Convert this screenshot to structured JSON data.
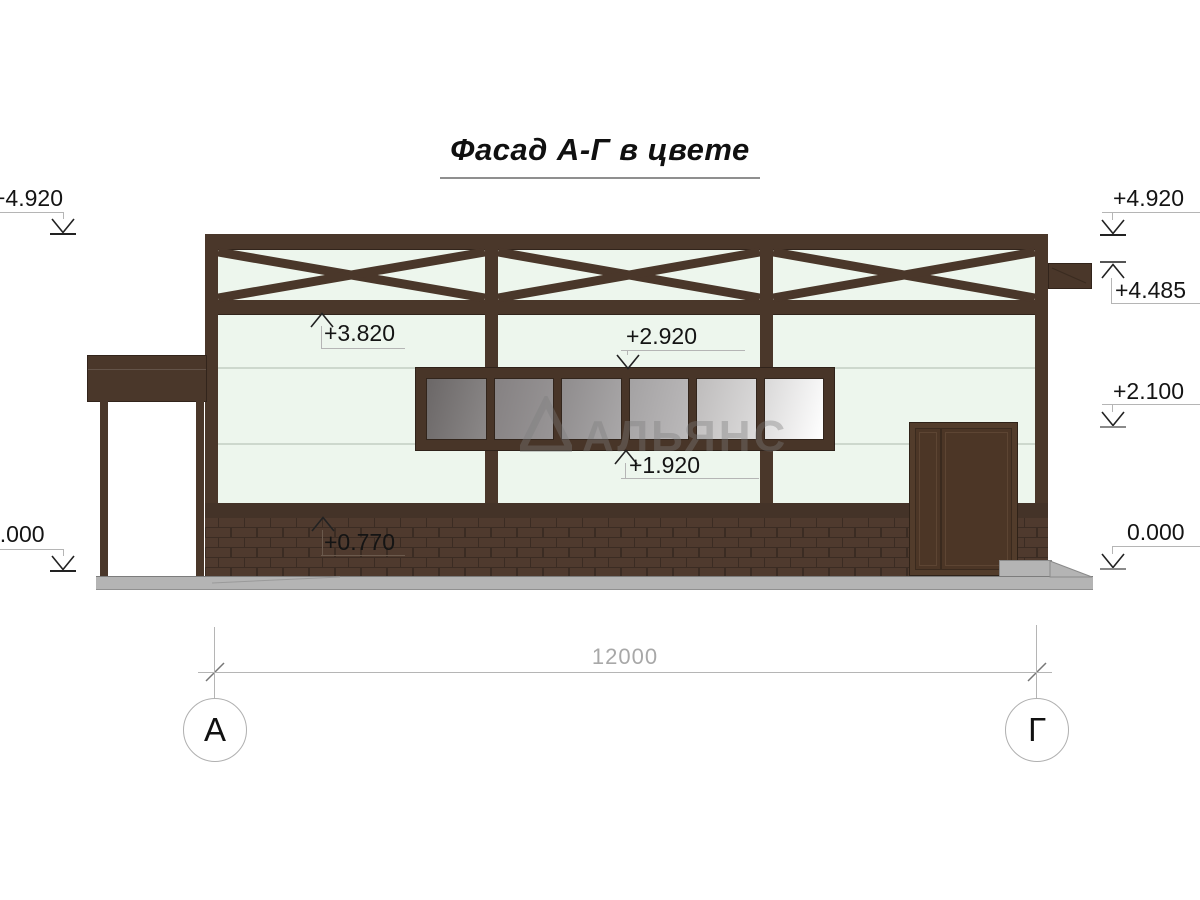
{
  "title": "Фасад А-Г в цвете",
  "watermark_text": "АЛЬЯНС",
  "elevations": {
    "left_top": "+4.920",
    "left_zero": "0.000",
    "right_top": "+4.920",
    "right_truss_bottom": "+4.485",
    "right_mid": "+2.100",
    "right_zero": "0.000",
    "beam_bottom": "+3.820",
    "window_top": "+2.920",
    "window_sill": "+1.920",
    "brick_top": "+0.770"
  },
  "dimensions": {
    "overall_width": "12000"
  },
  "axes": {
    "left_label": "А",
    "right_label": "Г"
  },
  "colors": {
    "frame_brown": "#4a372a",
    "wall_mint": "#edf6ed",
    "brick_brown": "#4f3a2e",
    "ground_gray": "#b4b4b4",
    "glass_dark": "#6b6767",
    "glass_light": "#ffffff"
  }
}
